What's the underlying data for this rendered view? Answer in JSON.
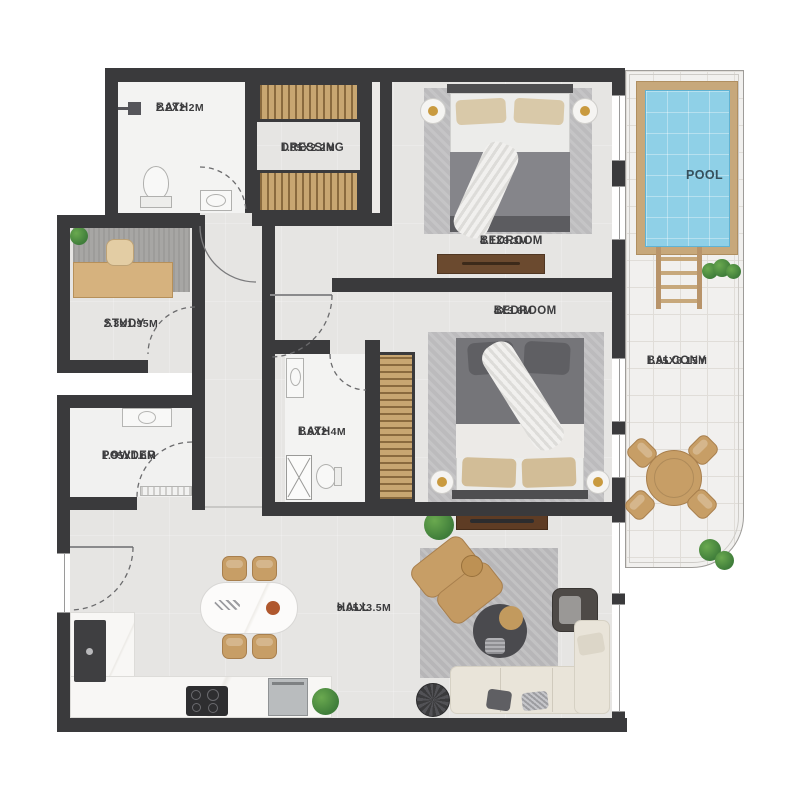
{
  "title": "Apartment floor plan",
  "colors": {
    "wall": "#3a3a3c",
    "floor": "#e6e5e3",
    "bath_floor": "#f3f3f2",
    "wood": "#c8a671",
    "wood_dark": "#8a6a3e",
    "pool_water": "#8fd0e7",
    "deck": "#c7a87b",
    "balcony_floor": "#f1f0ee",
    "label": "#3c3c3e",
    "sofa": "#e9e4d9",
    "tan": "#c79e66",
    "rug": "#bcbbbd"
  },
  "rooms": [
    {
      "id": "bath-1",
      "name": "BATH",
      "dims": "2.2X2.2M"
    },
    {
      "id": "dressing",
      "name": "DRESSING",
      "dims": "1.85X2.2M"
    },
    {
      "id": "bedroom-1",
      "name": "BEDROOM",
      "dims": "4.1X3.3M"
    },
    {
      "id": "pool",
      "name": "POOL",
      "dims": ""
    },
    {
      "id": "study",
      "name": "STUDY",
      "dims": "2.3X1.95M"
    },
    {
      "id": "bedroom-2",
      "name": "BEDROOM",
      "dims": "4X3.6M"
    },
    {
      "id": "bath-2",
      "name": "BATH",
      "dims": "1.6X2.4M"
    },
    {
      "id": "balcony",
      "name": "BALCONY",
      "dims": "1.85X8.15M"
    },
    {
      "id": "powder",
      "name": "POWDER",
      "dims": "1.95X1.6M"
    },
    {
      "id": "hall",
      "name": "HALL",
      "dims": "9.05X3.5M"
    }
  ]
}
